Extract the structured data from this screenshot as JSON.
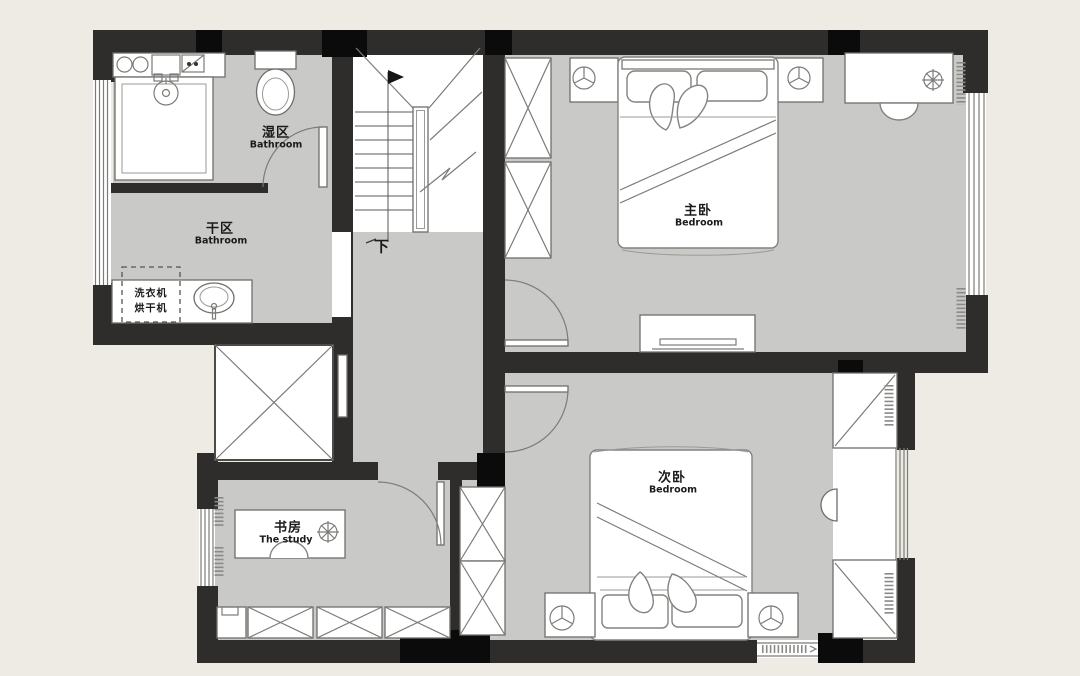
{
  "app": {
    "type": "residential floor plan",
    "description": "Upper-floor plan with two bedrooms, study, split bathroom and staircase"
  },
  "colors": {
    "background": "#EDEBE4",
    "floor": "#C9C9C7",
    "wall": "#2E2D2B",
    "column": "#0B0B0B",
    "furniture_line": "#7B7B78",
    "white": "#FFFFFF",
    "text": "#1A1A1A"
  },
  "rooms": [
    {
      "id": "wet-bathroom",
      "label_zh": "湿区",
      "label_en": "Bathroom"
    },
    {
      "id": "dry-bathroom",
      "label_zh": "干区",
      "label_en": "Bathroom"
    },
    {
      "id": "master-bedroom",
      "label_zh": "主卧",
      "label_en": "Bedroom"
    },
    {
      "id": "second-bedroom",
      "label_zh": "次卧",
      "label_en": "Bedroom"
    },
    {
      "id": "study",
      "label_zh": "书房",
      "label_en": "The study"
    }
  ],
  "annotations": {
    "stairs_down": "下",
    "washing_machine": "洗衣机",
    "dryer": "烘干机"
  },
  "fixtures": [
    "shower",
    "toilet",
    "basin-counter",
    "laundry-counter-with-sink",
    "elevator-shaft",
    "staircase",
    "wardrobe",
    "double-bed",
    "nightstand-with-lamp",
    "desk",
    "chair",
    "plant",
    "tv-cabinet",
    "bay-window",
    "casement-window",
    "storage-cabinets",
    "curtains"
  ]
}
